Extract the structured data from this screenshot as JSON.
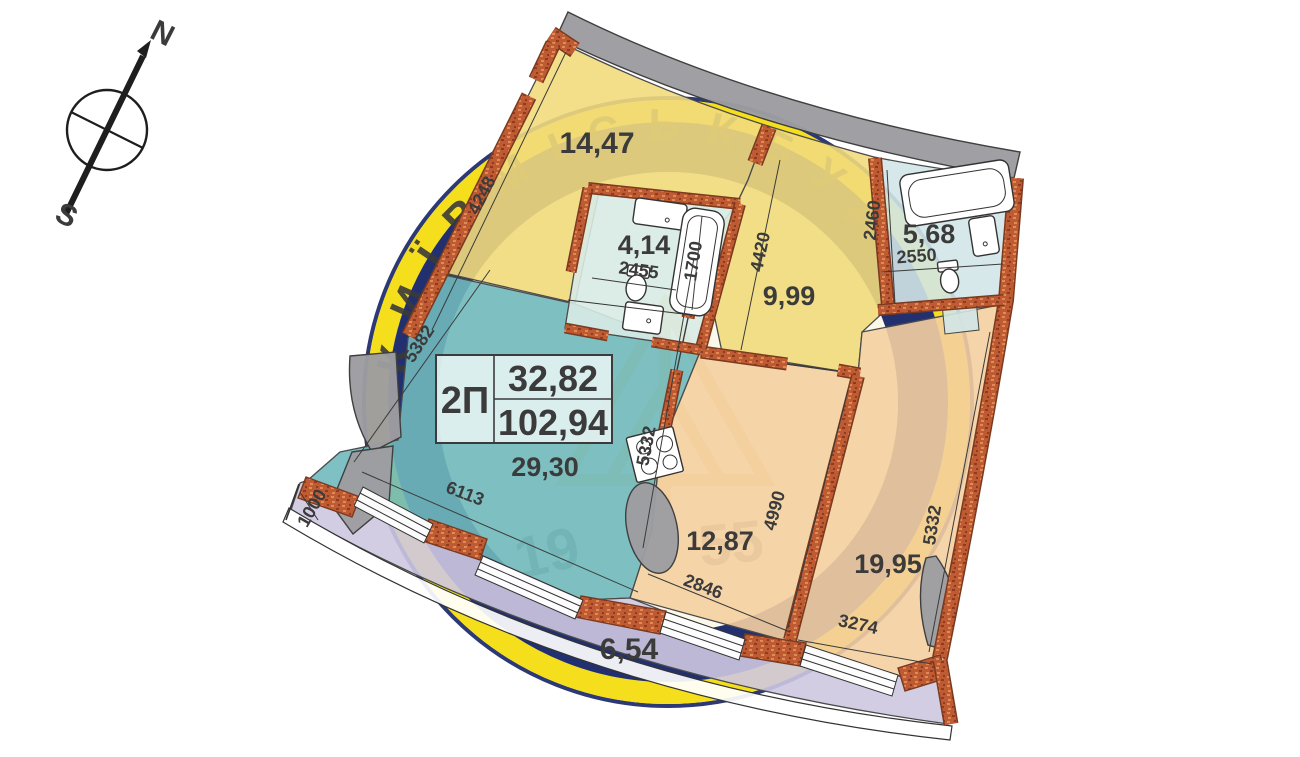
{
  "compass": {
    "north": "N",
    "south": "S"
  },
  "title_block": {
    "type": "2П",
    "living_area": "32,82",
    "total_area": "102,94"
  },
  "rooms": {
    "bedroom": {
      "area": "14,47"
    },
    "bathroom_small": {
      "area": "4,14"
    },
    "hallway": {
      "area": "9,99"
    },
    "bathroom_large": {
      "area": "5,68"
    },
    "living_kitchen": {
      "area": "29,30"
    },
    "room_middle": {
      "area": "12,87"
    },
    "room_right": {
      "area": "19,95"
    },
    "balcony": {
      "area": "6,54"
    }
  },
  "dimensions": {
    "bedroom_side": "4248",
    "hall_side": "4420",
    "bathroom_width": "2455",
    "bathtub_length": "1700",
    "bathroom2_side": "2460",
    "bathroom2_width": "2550",
    "living_left": "5382",
    "living_right": "5332",
    "living_bottom": "6113",
    "room_middle_side": "4990",
    "room_middle_bottom": "2846",
    "room_right_bottom": "3274",
    "room_right_side": "5332",
    "balcony_width": "1000"
  },
  "watermark": {
    "brand": "КИЇВМІСЬКБУД",
    "year_left": "19",
    "year_right": "55"
  },
  "colors": {
    "wall_brick": "#BE5B33",
    "room_yellow": "#F2DA7D",
    "room_teal": "#70B9BC",
    "room_orange": "#F4CFA1",
    "bathroom_blue": "#D2E6E7",
    "balcony_lavender": "#CEC8E1",
    "concrete_gray": "#9D9DA1",
    "logo_navy": "#22306F",
    "logo_yellow": "#F5DF1C",
    "text_dark": "#3B3B3B"
  }
}
